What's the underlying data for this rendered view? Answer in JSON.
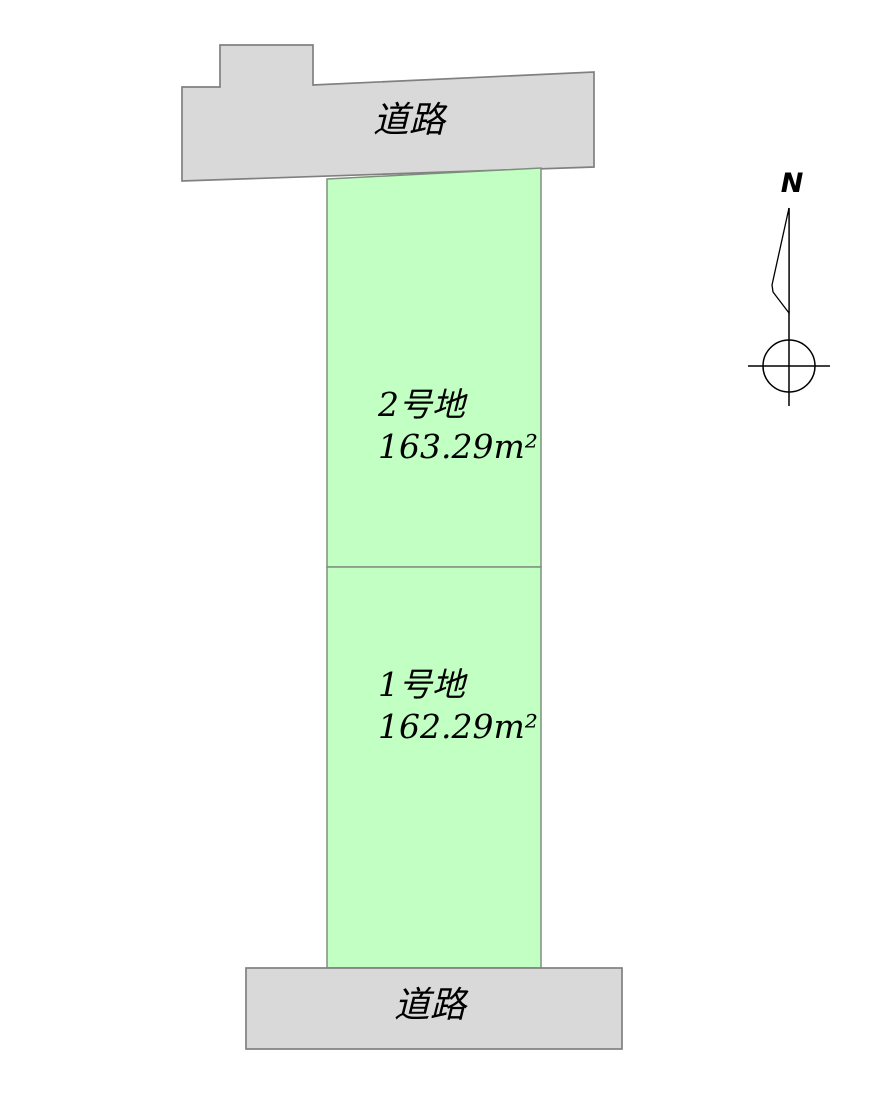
{
  "diagram": {
    "type": "land-plot-layout",
    "roads": {
      "top": {
        "label": "道路"
      },
      "bottom": {
        "label": "道路"
      }
    },
    "plots": [
      {
        "name": "2号地",
        "area": "163.29m²"
      },
      {
        "name": "1号地",
        "area": "162.29m²"
      }
    ],
    "compass": {
      "north_label": "N"
    },
    "colors": {
      "background": "#ffffff",
      "road_fill": "#d9d9d9",
      "road_border": "#808080",
      "plot_fill": "#c2ffc2",
      "plot_border": "#7f8f7f",
      "compass_stroke": "#000000",
      "text": "#000000"
    }
  }
}
